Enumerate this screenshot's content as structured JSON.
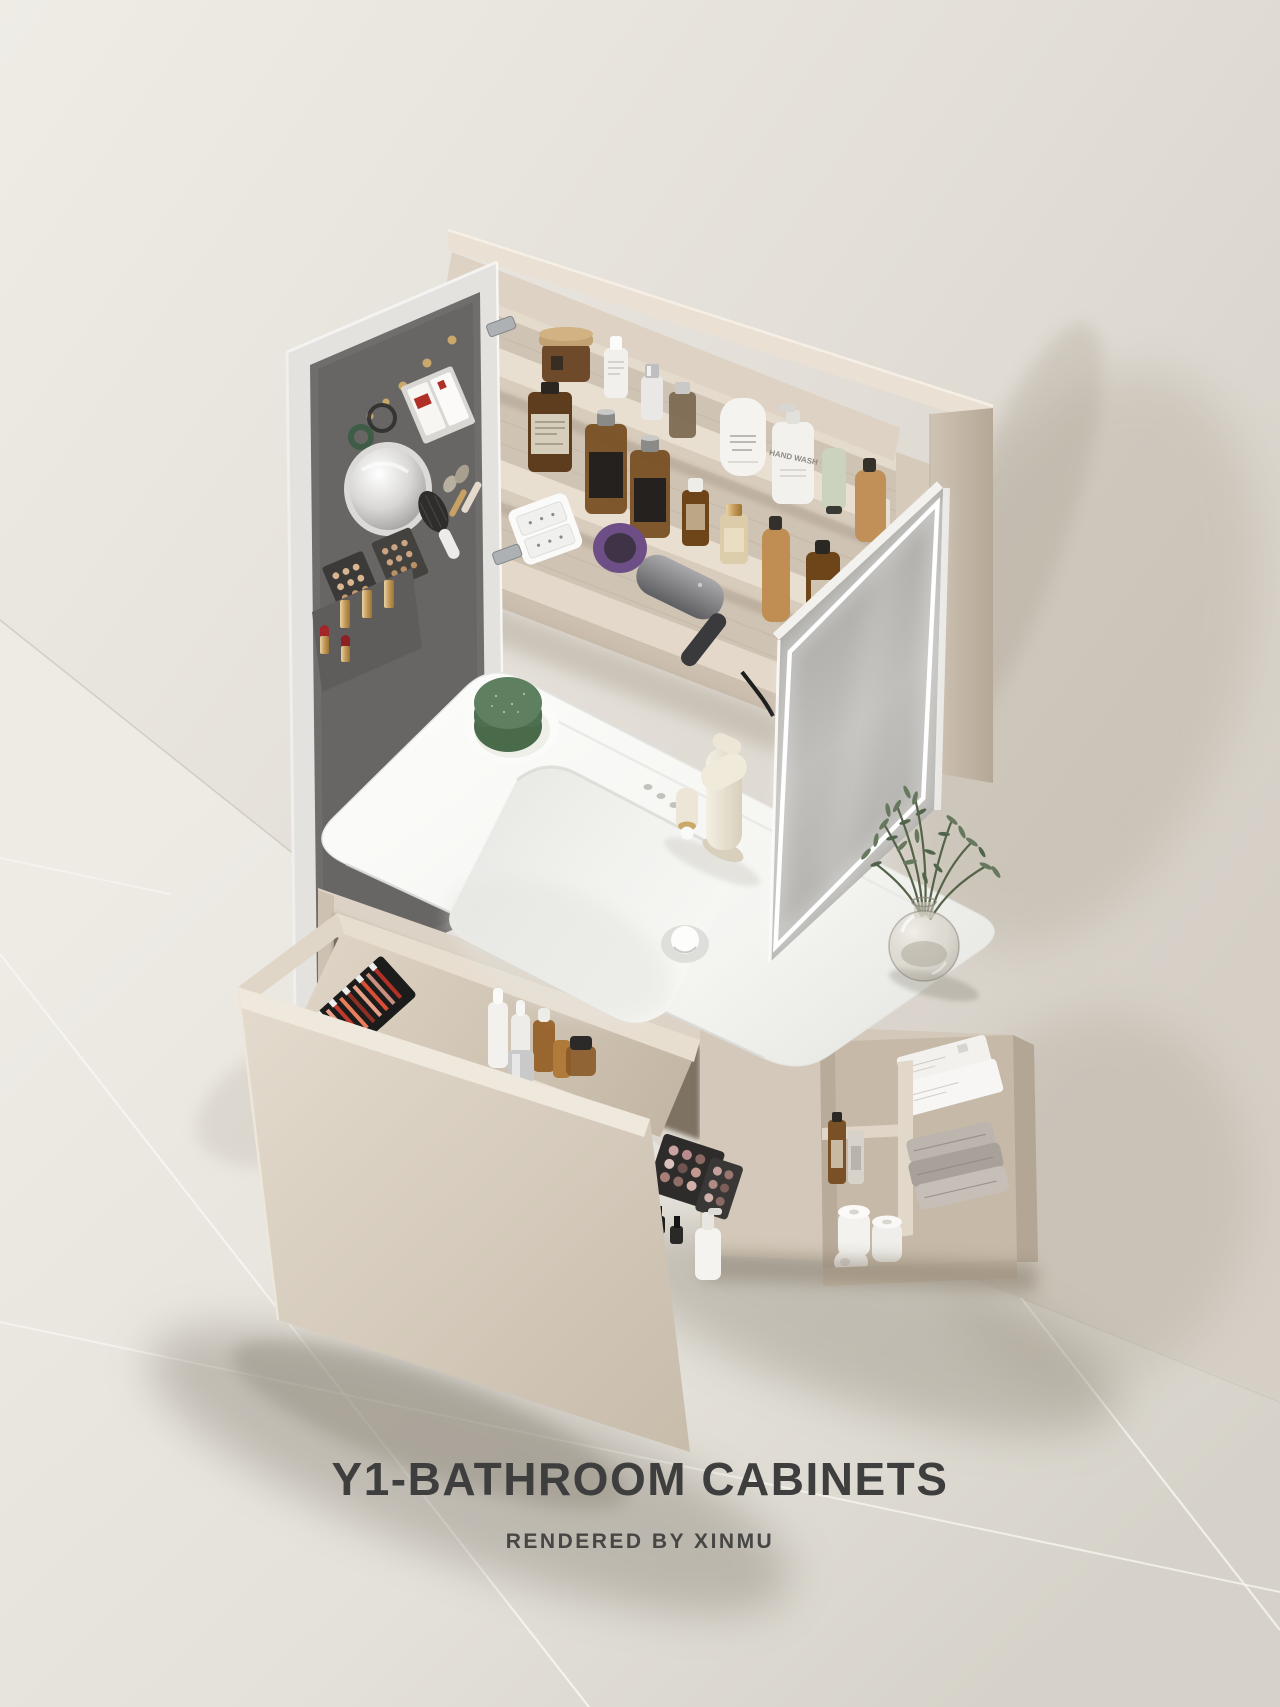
{
  "caption": {
    "title": "Y1-BATHROOM CABINETS",
    "subtitle": "RENDERED BY XINMU"
  },
  "labels": {
    "hand_wash_bottle": "HAND WASH"
  },
  "palette": {
    "wall": "#E3DFD8",
    "wall_shadow": "#B2A897",
    "floor": "#ECE9E3",
    "floor_seam": "#F7F5F0",
    "cabinet_greige": "#D8CCBE",
    "cabinet_interior": "#CEC2B3",
    "shelf_top": "#EADFD2",
    "door_panel_gray": "#6F6E6C",
    "mirror_glass": "#BDBCB8",
    "led_white": "#FFFFFF",
    "basin_white": "#F8F8F6",
    "faucet_cream": "#EFE8D9",
    "soap_dish_green": "#5E8060",
    "amber_glass": "#8A5A28",
    "towel_gray": "#AFA8A1",
    "lipstick_red": "#A3262A",
    "title_text": "#3E3E3E"
  },
  "scene": {
    "mirror_cabinet": {
      "left_door_items": [
        "jewelry-hooks",
        "bracelet",
        "hair-tie",
        "card-pocket",
        "round-mirror",
        "makeup-palettes",
        "hair-brush",
        "makeup-brushes",
        "lipsticks"
      ],
      "shelf_items": [
        "wood-lid-jar",
        "dropper-bottles",
        "perfume-bottles",
        "herb-lotion-bottle",
        "hand-wash-pump",
        "cosmetic-tube",
        "tan-pump-bottles",
        "power-socket",
        "hair-dryer",
        "serum-bottles",
        "foundation-bottle"
      ]
    },
    "countertop": {
      "items": [
        "green-soap-dish",
        "cream-faucet",
        "drain-cover",
        "faucet-holes",
        "olive-vase"
      ]
    },
    "vanity": {
      "drawer_items": [
        "lip-gloss-set",
        "dropper-bottles",
        "amber-bottles",
        "silver-jar",
        "black-cap-jar",
        "eyeshadow-palettes",
        "cotton-pad-roll",
        "nail-polish",
        "lotion-pump"
      ],
      "open_shelf_items": [
        "tissue-boxes",
        "amber-bottles",
        "paper-rolls",
        "folded-towels"
      ]
    }
  }
}
